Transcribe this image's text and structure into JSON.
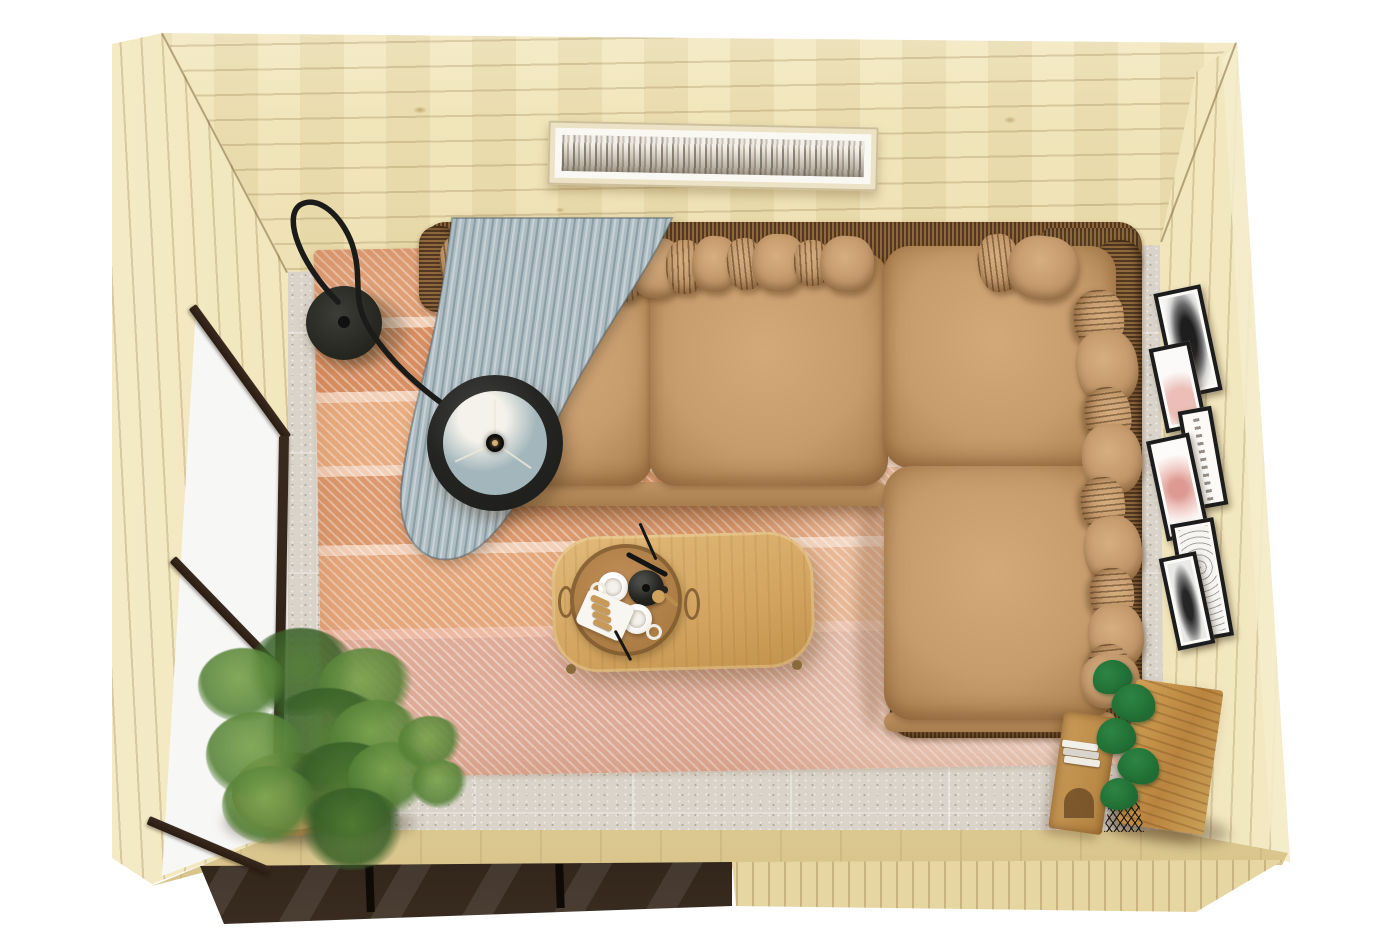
{
  "meta": {
    "description": "Top-down 3D render of a pine garden-room interior: L-shaped tan leather sofa with rattan frame and many pillows, light blue throw blanket, black arc floor lamp, striped salmon rug on terrazzo floor, oval oak coffee table with tray of mugs and teapot, asparagus fern in wooden bowl, round side stool, oak sideboard with books and monstera, six black picture frames on the right wall, panoramic birch-forest artwork on the back wall, glazed door wall on the left and glazed strip on the front wall.",
    "width_px": 1400,
    "height_px": 934
  },
  "palette": {
    "bg": "#ffffff",
    "wood_light": "#f0e4b6",
    "wood_mid": "#e6d5a0",
    "wood_deep": "#d6c186",
    "wood_edge": "#f5eccb",
    "wicker": "#7d5b37",
    "wicker_dark": "#57401f",
    "sofa": "#c79c6d",
    "sofa_light": "#dab289",
    "sofa_deep": "#aa8152",
    "blanket": "#aebdc3",
    "blanket_deep": "#93a7ae",
    "lamp": "#222321",
    "lamp_inner": "#a3b6bc",
    "rug_a": "#e0a077",
    "rug_b": "#f2d0b8",
    "rug_c": "#d88f62",
    "rug_d": "#ddab97",
    "floor": "#d9d3c9",
    "glass": "#f4f4f2",
    "mullion": "#2a1c12",
    "table_wood": "#d9b06c",
    "tray": "#b0804a",
    "oak": "#c3924d",
    "leaf": "#5f8a3e",
    "leaf_deep": "#3c6527",
    "monstera": "#1f6b33",
    "frame_black": "#1c1c1c",
    "art_cream": "#ece2c6",
    "blush": "#eec4bd"
  },
  "scene": {
    "room": {
      "material": "pine plank walls",
      "view": "bird's-eye interior",
      "window_walls": [
        "left",
        "front-left"
      ]
    },
    "back_wall_art": {
      "type": "panoramic birch forest print",
      "frame": "cream wood with white mat"
    },
    "floor": {
      "type": "grey terrazzo tiles"
    },
    "rug": {
      "style": "diagonal-weave stripes",
      "tones": [
        "salmon",
        "terracotta",
        "cream",
        "dusty rose"
      ]
    },
    "sofa": {
      "shape": "L-shaped",
      "upholstery": "tan leather",
      "frame": "dark rattan wicker",
      "seat_cushions": 4,
      "pillows": 22,
      "throw": "light blue-grey blanket"
    },
    "lamp": {
      "type": "black arc floor lamp",
      "parts": [
        "round base",
        "curved arm",
        "drum shade seen from above"
      ]
    },
    "coffee_table": {
      "shape": "oval oak",
      "tray_items": [
        "white mug",
        "white mug",
        "black teapot",
        "biscuit plate",
        "wooden scoop",
        "black tongs"
      ]
    },
    "plants": [
      {
        "type": "asparagus fern",
        "container": "round wooden bowl",
        "location": "bottom-left by glass door"
      },
      {
        "type": "monstera",
        "container": "black wire stand",
        "location": "bottom-right by sideboard"
      }
    ],
    "side_stool": {
      "type": "round wooden stool",
      "items": [
        "dark book",
        "white paper"
      ]
    },
    "sideboard": {
      "material": "rustic oak",
      "contents": [
        "stacked books"
      ]
    },
    "right_wall_frames": {
      "count": 6,
      "frame_color": "black",
      "artworks": [
        "dark feather sketch",
        "blush print",
        "handwritten script print",
        "pink watercolor",
        "octopus line drawing",
        "small dark feather"
      ]
    }
  }
}
